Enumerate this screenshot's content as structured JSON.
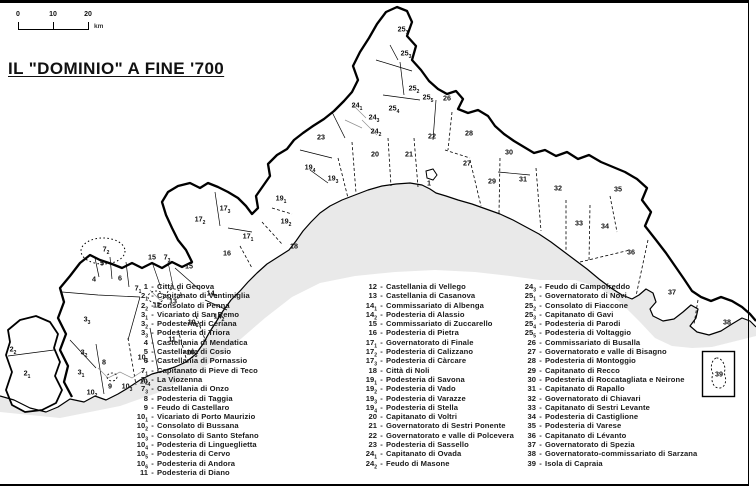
{
  "title": "IL \"DOMINIO\" A FINE '700",
  "scale_bar": {
    "ticks": [
      "0",
      "10",
      "20"
    ],
    "unit": "km"
  },
  "legend": {
    "separator": "-",
    "columns": [
      {
        "entries": [
          {
            "num": "1",
            "sub": "",
            "name": "Città di Genova"
          },
          {
            "num": "2",
            "sub": "1",
            "name": "Capitanato di Ventimiglia"
          },
          {
            "num": "2",
            "sub": "2",
            "name": "Consolato di Penna"
          },
          {
            "num": "3",
            "sub": "1",
            "name": "Vicariato di San Remo"
          },
          {
            "num": "3",
            "sub": "2",
            "name": "Podesteria di Ceriana"
          },
          {
            "num": "3",
            "sub": "3",
            "name": "Podesteria di Triora"
          },
          {
            "num": "4",
            "sub": "",
            "name": "Castellania di Mendatica"
          },
          {
            "num": "5",
            "sub": "",
            "name": "Castellania di Cosio"
          },
          {
            "num": "6",
            "sub": "",
            "name": "Castellania di Pornassio"
          },
          {
            "num": "7",
            "sub": "1",
            "name": "Capitanato di Pieve di Teco"
          },
          {
            "num": "7",
            "sub": "2",
            "name": "La Viozenna"
          },
          {
            "num": "7",
            "sub": "3",
            "name": "Castellania di Onzo"
          },
          {
            "num": "8",
            "sub": "",
            "name": "Podesteria di Taggia"
          },
          {
            "num": "9",
            "sub": "",
            "name": "Feudo di Castellaro"
          },
          {
            "num": "10",
            "sub": "1",
            "name": "Vicariato di Porto Maurizio"
          },
          {
            "num": "10",
            "sub": "2",
            "name": "Consolato di Bussana"
          },
          {
            "num": "10",
            "sub": "3",
            "name": "Consolato di Santo Stefano"
          },
          {
            "num": "10",
            "sub": "4",
            "name": "Podesteria di Lingueglietta"
          },
          {
            "num": "10",
            "sub": "5",
            "name": "Podesteria di Cervo"
          },
          {
            "num": "10",
            "sub": "6",
            "name": "Podesteria di Andora"
          },
          {
            "num": "11",
            "sub": "",
            "name": "Podesteria di Diano"
          }
        ]
      },
      {
        "entries": [
          {
            "num": "12",
            "sub": "",
            "name": "Castellania di Vellego"
          },
          {
            "num": "13",
            "sub": "",
            "name": "Castellania di Casanova"
          },
          {
            "num": "14",
            "sub": "1",
            "name": "Commissariato di Albenga"
          },
          {
            "num": "14",
            "sub": "2",
            "name": "Podesteria di Alassio"
          },
          {
            "num": "15",
            "sub": "",
            "name": "Commissariato di Zuccarello"
          },
          {
            "num": "16",
            "sub": "",
            "name": "Podesteria di Pietra"
          },
          {
            "num": "17",
            "sub": "1",
            "name": "Governatorato di Finale"
          },
          {
            "num": "17",
            "sub": "2",
            "name": "Podesteria di Calizzano"
          },
          {
            "num": "17",
            "sub": "3",
            "name": "Podesteria di Càrcare"
          },
          {
            "num": "18",
            "sub": "",
            "name": "Città di Noli"
          },
          {
            "num": "19",
            "sub": "1",
            "name": "Podesteria di Savona"
          },
          {
            "num": "19",
            "sub": "2",
            "name": "Podesteria di Vado"
          },
          {
            "num": "19",
            "sub": "3",
            "name": "Podesteria di Varazze"
          },
          {
            "num": "19",
            "sub": "4",
            "name": "Podesteria di Stella"
          },
          {
            "num": "20",
            "sub": "",
            "name": "Capitanato di Voltri"
          },
          {
            "num": "21",
            "sub": "",
            "name": "Governatorato di Sestri Ponente"
          },
          {
            "num": "22",
            "sub": "",
            "name": "Governatorato e valle di Polcevera"
          },
          {
            "num": "23",
            "sub": "",
            "name": "Podesteria di Sassello"
          },
          {
            "num": "24",
            "sub": "1",
            "name": "Capitanato di Ovada"
          },
          {
            "num": "24",
            "sub": "2",
            "name": "Feudo di Masone"
          }
        ]
      },
      {
        "entries": [
          {
            "num": "24",
            "sub": "3",
            "name": "Feudo di Campofreddo"
          },
          {
            "num": "25",
            "sub": "1",
            "name": "Governatorato di Novi"
          },
          {
            "num": "25",
            "sub": "2",
            "name": "Consolato di Fiaccone"
          },
          {
            "num": "25",
            "sub": "3",
            "name": "Capitanato di Gavi"
          },
          {
            "num": "25",
            "sub": "4",
            "name": "Podesteria di Parodi"
          },
          {
            "num": "25",
            "sub": "5",
            "name": "Podesteria di Voltaggio"
          },
          {
            "num": "26",
            "sub": "",
            "name": "Commissariato di Busalla"
          },
          {
            "num": "27",
            "sub": "",
            "name": "Governatorato e valle di Bisagno"
          },
          {
            "num": "28",
            "sub": "",
            "name": "Podesteria di Montoggio"
          },
          {
            "num": "29",
            "sub": "",
            "name": "Capitanato di Recco"
          },
          {
            "num": "30",
            "sub": "",
            "name": "Podesteria di Roccatagliata e Neirone"
          },
          {
            "num": "31",
            "sub": "",
            "name": "Capitanato di Rapallo"
          },
          {
            "num": "32",
            "sub": "",
            "name": "Governatorato di Chiavari"
          },
          {
            "num": "33",
            "sub": "",
            "name": "Capitanato di Sestri Levante"
          },
          {
            "num": "34",
            "sub": "",
            "name": "Podesteria di Castiglione"
          },
          {
            "num": "35",
            "sub": "",
            "name": "Podesteria di Varese"
          },
          {
            "num": "36",
            "sub": "",
            "name": "Capitanato di Lévanto"
          },
          {
            "num": "37",
            "sub": "",
            "name": "Governatorato di Spezia"
          },
          {
            "num": "38",
            "sub": "",
            "name": "Governatorato-commissariato di Sarzana"
          },
          {
            "num": "39",
            "sub": "",
            "name": "Isola di Capraia"
          }
        ]
      }
    ]
  },
  "map_labels": [
    {
      "num": "1",
      "sub": "",
      "x": 429,
      "y": 183
    },
    {
      "num": "2",
      "sub": "1",
      "x": 27,
      "y": 373
    },
    {
      "num": "2",
      "sub": "2",
      "x": 13,
      "y": 349
    },
    {
      "num": "3",
      "sub": "1",
      "x": 81,
      "y": 372
    },
    {
      "num": "3",
      "sub": "2",
      "x": 84,
      "y": 352
    },
    {
      "num": "3",
      "sub": "3",
      "x": 87,
      "y": 319
    },
    {
      "num": "4",
      "sub": "",
      "x": 94,
      "y": 279
    },
    {
      "num": "5",
      "sub": "",
      "x": 102,
      "y": 263
    },
    {
      "num": "6",
      "sub": "",
      "x": 120,
      "y": 278
    },
    {
      "num": "7",
      "sub": "1",
      "x": 138,
      "y": 288
    },
    {
      "num": "7",
      "sub": "2",
      "x": 106,
      "y": 249
    },
    {
      "num": "7",
      "sub": "3",
      "x": 167,
      "y": 257
    },
    {
      "num": "8",
      "sub": "",
      "x": 104,
      "y": 362
    },
    {
      "num": "9",
      "sub": "",
      "x": 110,
      "y": 386
    },
    {
      "num": "10",
      "sub": "1",
      "x": 143,
      "y": 357
    },
    {
      "num": "10",
      "sub": "2",
      "x": 92,
      "y": 392
    },
    {
      "num": "10",
      "sub": "3",
      "x": 127,
      "y": 386
    },
    {
      "num": "10",
      "sub": "4",
      "x": 145,
      "y": 381
    },
    {
      "num": "10",
      "sub": "5",
      "x": 192,
      "y": 352
    },
    {
      "num": "10",
      "sub": "6",
      "x": 193,
      "y": 322
    },
    {
      "num": "11",
      "sub": "",
      "x": 172,
      "y": 339
    },
    {
      "num": "12",
      "sub": "",
      "x": 157,
      "y": 305
    },
    {
      "num": "13",
      "sub": "",
      "x": 173,
      "y": 301
    },
    {
      "num": "14",
      "sub": "1",
      "x": 212,
      "y": 293
    },
    {
      "num": "14",
      "sub": "2",
      "x": 219,
      "y": 316
    },
    {
      "num": "15",
      "sub": "",
      "x": 152,
      "y": 257
    },
    {
      "num": "15",
      "sub": "",
      "x": 189,
      "y": 266
    },
    {
      "num": "16",
      "sub": "",
      "x": 227,
      "y": 253
    },
    {
      "num": "17",
      "sub": "1",
      "x": 248,
      "y": 236
    },
    {
      "num": "17",
      "sub": "2",
      "x": 200,
      "y": 219
    },
    {
      "num": "17",
      "sub": "3",
      "x": 225,
      "y": 208
    },
    {
      "num": "18",
      "sub": "",
      "x": 294,
      "y": 246
    },
    {
      "num": "19",
      "sub": "1",
      "x": 281,
      "y": 198
    },
    {
      "num": "19",
      "sub": "2",
      "x": 286,
      "y": 221
    },
    {
      "num": "19",
      "sub": "3",
      "x": 333,
      "y": 178
    },
    {
      "num": "19",
      "sub": "4",
      "x": 310,
      "y": 167
    },
    {
      "num": "20",
      "sub": "",
      "x": 375,
      "y": 154
    },
    {
      "num": "21",
      "sub": "",
      "x": 409,
      "y": 154
    },
    {
      "num": "22",
      "sub": "",
      "x": 432,
      "y": 136
    },
    {
      "num": "23",
      "sub": "",
      "x": 321,
      "y": 137
    },
    {
      "num": "24",
      "sub": "1",
      "x": 357,
      "y": 105
    },
    {
      "num": "24",
      "sub": "2",
      "x": 376,
      "y": 131
    },
    {
      "num": "24",
      "sub": "3",
      "x": 374,
      "y": 117
    },
    {
      "num": "25",
      "sub": "1",
      "x": 403,
      "y": 29
    },
    {
      "num": "25",
      "sub": "2",
      "x": 414,
      "y": 88
    },
    {
      "num": "25",
      "sub": "3",
      "x": 406,
      "y": 53
    },
    {
      "num": "25",
      "sub": "4",
      "x": 394,
      "y": 108
    },
    {
      "num": "25",
      "sub": "5",
      "x": 428,
      "y": 97
    },
    {
      "num": "26",
      "sub": "",
      "x": 447,
      "y": 98
    },
    {
      "num": "27",
      "sub": "",
      "x": 467,
      "y": 163
    },
    {
      "num": "28",
      "sub": "",
      "x": 469,
      "y": 133
    },
    {
      "num": "29",
      "sub": "",
      "x": 492,
      "y": 181
    },
    {
      "num": "30",
      "sub": "",
      "x": 509,
      "y": 152
    },
    {
      "num": "31",
      "sub": "",
      "x": 523,
      "y": 179
    },
    {
      "num": "32",
      "sub": "",
      "x": 558,
      "y": 188
    },
    {
      "num": "33",
      "sub": "",
      "x": 579,
      "y": 223
    },
    {
      "num": "34",
      "sub": "",
      "x": 605,
      "y": 226
    },
    {
      "num": "35",
      "sub": "",
      "x": 618,
      "y": 189
    },
    {
      "num": "36",
      "sub": "",
      "x": 631,
      "y": 252
    },
    {
      "num": "37",
      "sub": "",
      "x": 672,
      "y": 292
    },
    {
      "num": "38",
      "sub": "",
      "x": 727,
      "y": 322
    },
    {
      "num": "39",
      "sub": "",
      "x": 719,
      "y": 374
    }
  ],
  "colors": {
    "sea": "#e9e9e9",
    "ink": "#111111",
    "light_border": "#8f8f8f"
  }
}
